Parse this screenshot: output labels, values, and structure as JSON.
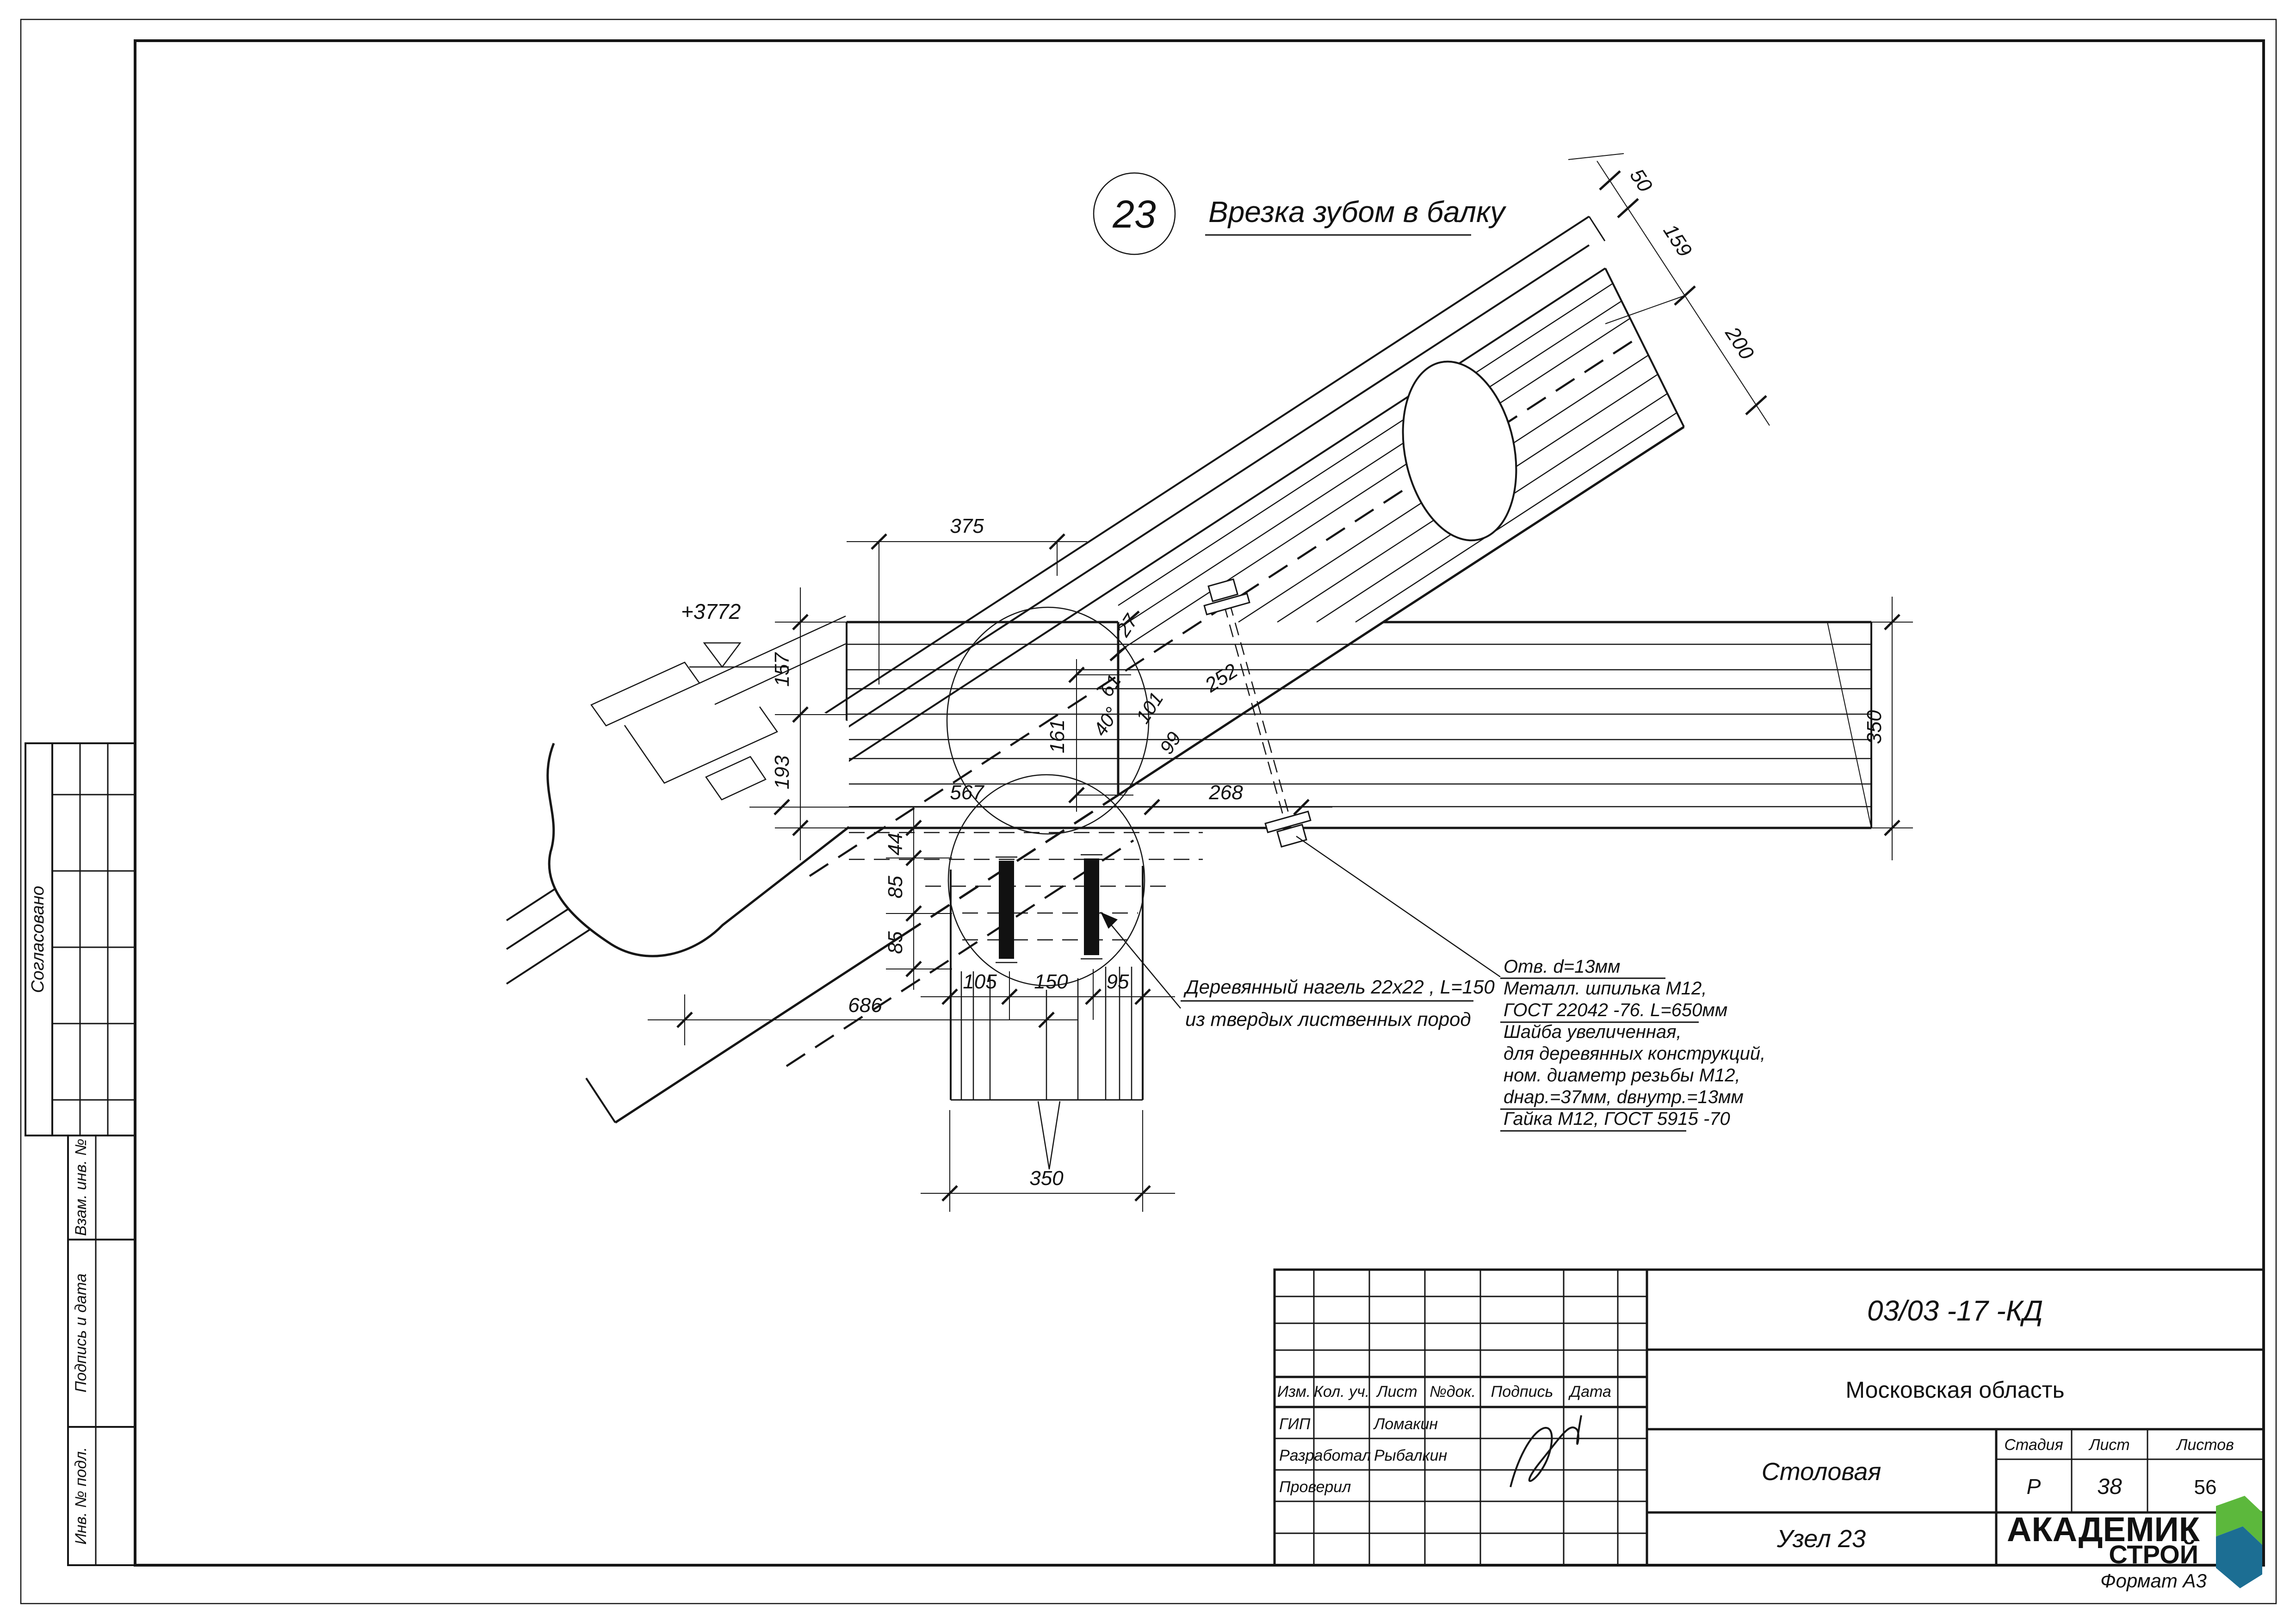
{
  "sheet": {
    "format_label": "Формат А3"
  },
  "title": {
    "node_number": "23",
    "caption": "Врезка зубом в балку"
  },
  "elevation_mark": "+3772",
  "dims": {
    "d375": "375",
    "d157": "157",
    "d193": "193",
    "d44": "44",
    "d85a": "85",
    "d85b": "85",
    "d105": "105",
    "d150": "150",
    "d95": "95",
    "d686": "686",
    "d350_bottom": "350",
    "d350_right": "350",
    "d567": "567",
    "d268": "268",
    "d161": "161",
    "d27": "27",
    "d61": "61",
    "d40": "40°",
    "d101": "101",
    "d252": "252",
    "d99": "99",
    "d50": "50",
    "d159": "159",
    "d200": "200"
  },
  "annotations": {
    "dowel_line1": "Деревянный нагель 22х22 , L=150",
    "dowel_line2": "из твердых лиственных пород",
    "stud_block": [
      "Отв. d=13мм",
      "Металл. шпилька М12,",
      "ГОСТ 22042 -76. L=650мм",
      "Шайба увеличенная,",
      "для деревянных конструкций,",
      "ном. диаметр резьбы М12,",
      "dнар.=37мм, dвнутр.=13мм",
      "Гайка М12, ГОСТ 5915 -70"
    ]
  },
  "side_panel": {
    "approved": "Согласовано",
    "vzam": "Взам. инв. №",
    "podpis_data": "Подпись и дата",
    "inv": "Инв. № подл."
  },
  "title_block": {
    "doc_number": "03/03 -17 -КД",
    "project": "Московская область",
    "object": "Столовая",
    "sheet_title": "Узел 23",
    "stage_label": "Стадия",
    "sheet_label": "Лист",
    "sheets_label": "Листов",
    "stage": "Р",
    "sheet": "38",
    "sheets": "56",
    "cols": {
      "izm": "Изм.",
      "kol": "Кол. уч.",
      "list": "Лист",
      "doc": "№док.",
      "sign": "Подпись",
      "date": "Дата"
    },
    "rows": [
      {
        "role": "ГИП",
        "name": "Ломакин"
      },
      {
        "role": "Разработал",
        "name": "Рыбалкин"
      },
      {
        "role": "Проверил",
        "name": ""
      }
    ],
    "logo": {
      "line1": "АКАДЕМИК",
      "line2": "СТРОЙ"
    }
  },
  "colors": {
    "logo_green": "#6cbf45",
    "logo_teal": "#1d9b85",
    "logo_blue": "#1c6e93"
  }
}
